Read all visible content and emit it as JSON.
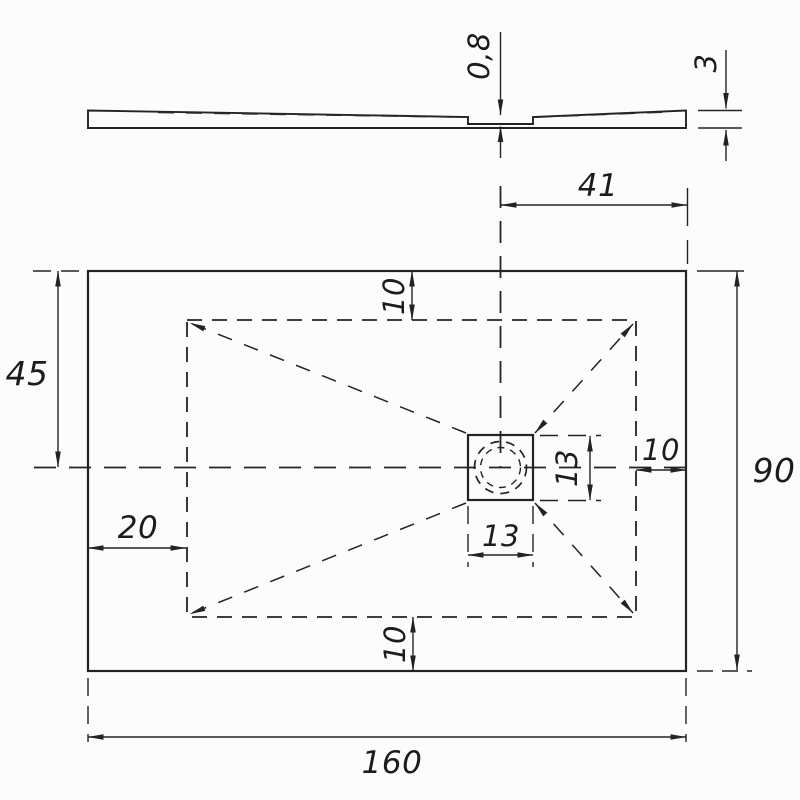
{
  "drawing": {
    "type": "shower-tray technical dimension drawing",
    "colors": {
      "background": "#fcfcfc",
      "line": "#232323",
      "text": "#1c1c1c"
    },
    "profile_view": {
      "recess_depth": "0,8",
      "edge_thickness": "3"
    },
    "plan_view": {
      "overall_width": "160",
      "overall_height": "90",
      "left_half_height": "45",
      "drain_offset_from_right": "41",
      "top_inset": "10",
      "bottom_inset": "10",
      "right_inset": "10",
      "left_inset": "20",
      "drain_width": "13",
      "drain_height": "13"
    }
  }
}
